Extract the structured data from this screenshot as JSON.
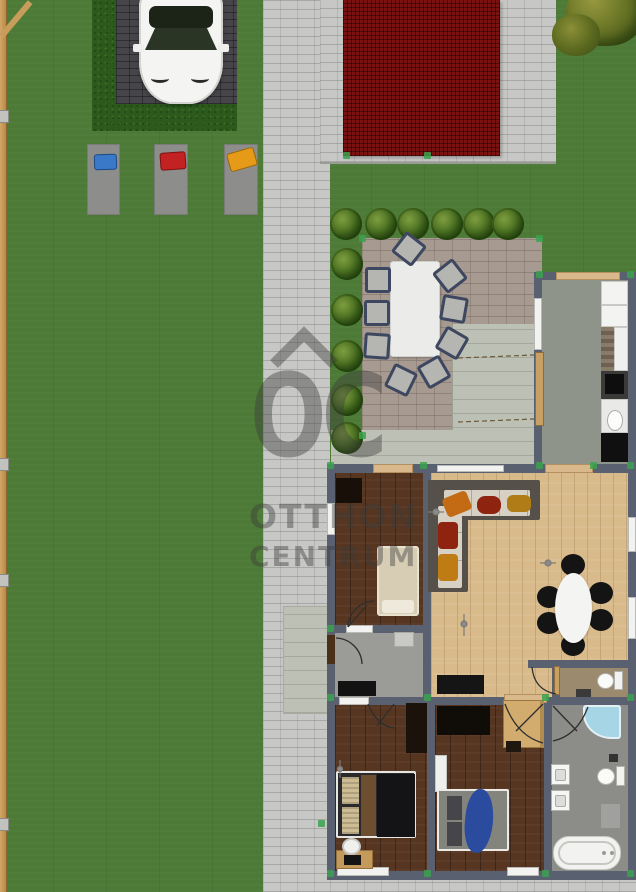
{
  "watermark": {
    "monogram": "OC",
    "line1": "OTTHON",
    "line2": "CENTRUM"
  },
  "colors": {
    "grass": "#4d7a36",
    "hedge": "#2c5a1d",
    "path": "#c7c7c5",
    "driveway": "#46454a",
    "roof": "#7c1210",
    "patio": "#a79a90",
    "concrete": "#bdc1b5",
    "wall": "#596070",
    "wood-dark": "#573621",
    "wood-light": "#d9ba8b",
    "kitchen-floor": "#8f948b",
    "hall-floor": "#9b9b97",
    "bath-floor": "#8c8c88",
    "wc-floor": "#9c8a6e",
    "handle-green": "#3aa24e",
    "pillow-blue": "#3a78c8",
    "pillow-red": "#c22222",
    "pillow-orange": "#e69b18",
    "blanket-blue": "#2a4b9e",
    "watermark-gray": "rgba(60,60,60,0.42)"
  }
}
